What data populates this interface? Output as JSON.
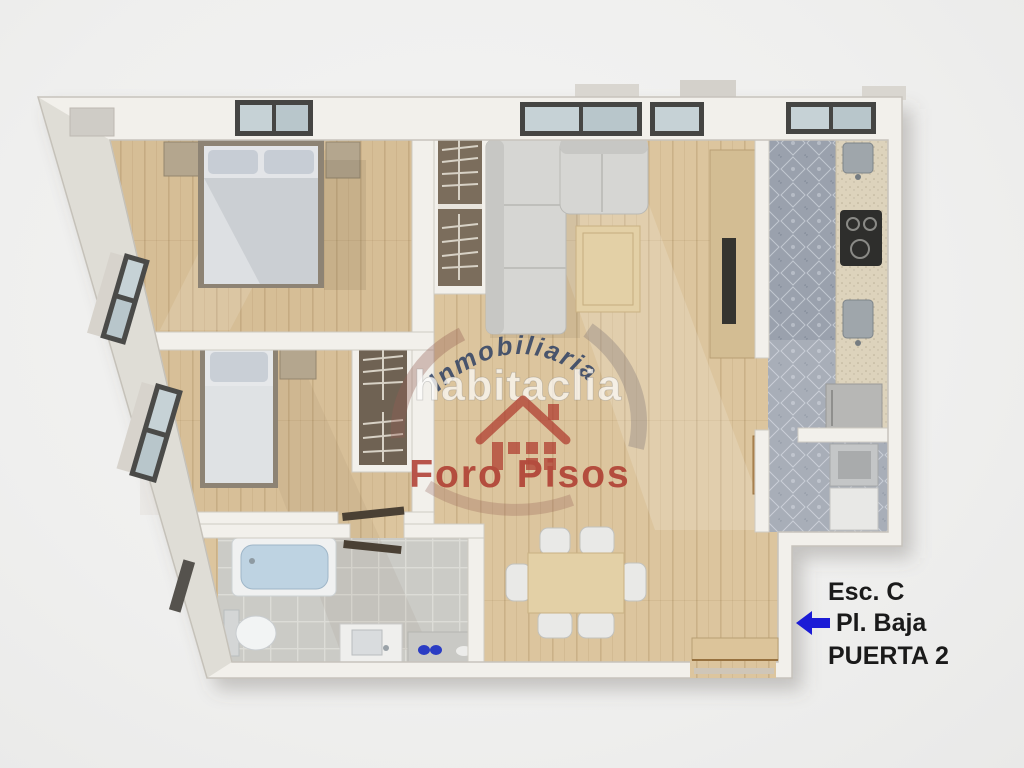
{
  "annotation": {
    "line1": "Esc. C",
    "line2": "Pl. Baja",
    "line3": "PUERTA 2",
    "arrow_color": "#1b1bd6",
    "text_color": "#1a1a1a"
  },
  "watermark": {
    "arc_text": "Inmobiliaria",
    "brand_text": "habitaclia",
    "footer_text": "Foro Pisos",
    "navy_color": "#2c3f63",
    "red_color": "#ad372c",
    "brand_text_color": "rgba(255,255,255,0.82)"
  },
  "palette": {
    "background": "#f0f0ef",
    "wall": "#f2f0eb",
    "wood_floor": "#dcc59e",
    "kitchen_tile": "#9aa1ad",
    "bath_tile": "#cbcbc6",
    "sofa": "#d6d6d3",
    "bed_linen": "#e3e5e8",
    "bathtub": "#bed3e2",
    "table_wood": "#e3d0a6"
  }
}
